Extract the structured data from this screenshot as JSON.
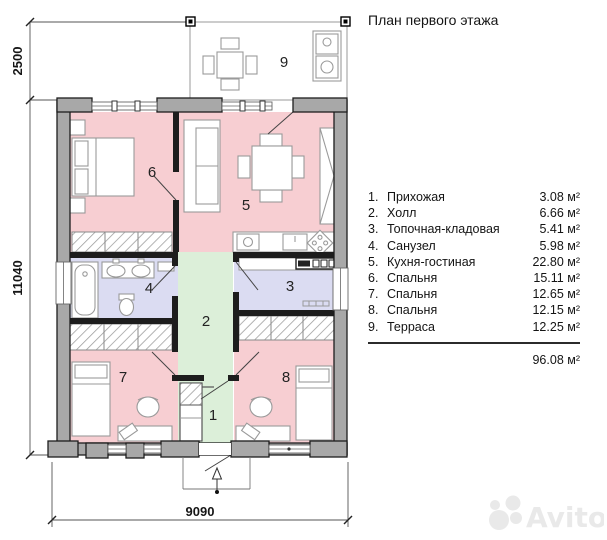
{
  "title": "План первого этажа",
  "legend": {
    "items": [
      {
        "num": "1.",
        "name": "Прихожая",
        "area": "3.08 м²"
      },
      {
        "num": "2.",
        "name": "Холл",
        "area": "6.66 м²"
      },
      {
        "num": "3.",
        "name": "Топочная-кладовая",
        "area": "5.41 м²"
      },
      {
        "num": "4.",
        "name": "Санузел",
        "area": "5.98 м²"
      },
      {
        "num": "5.",
        "name": "Кухня-гостиная",
        "area": "22.80 м²"
      },
      {
        "num": "6.",
        "name": "Спальня",
        "area": "15.11 м²"
      },
      {
        "num": "7.",
        "name": "Спальня",
        "area": "12.65 м²"
      },
      {
        "num": "8.",
        "name": "Спальня",
        "area": "12.15 м²"
      },
      {
        "num": "9.",
        "name": "Терраса",
        "area": "12.25 м²"
      }
    ],
    "total": "96.08 м²"
  },
  "plan": {
    "room_numbers": {
      "r1": "1",
      "r2": "2",
      "r3": "3",
      "r4": "4",
      "r5": "5",
      "r6": "6",
      "r7": "7",
      "r8": "8",
      "r9": "9"
    },
    "dimensions": {
      "top_left": "2500",
      "left": "11040",
      "bottom": "9090"
    },
    "colors": {
      "room_pink": "#f7ced2",
      "hall_green": "#dcefd9",
      "wet_blue": "#dbdcf2",
      "wall_gray": "#a8a8a8"
    }
  },
  "watermark": {
    "text": "Avito"
  }
}
